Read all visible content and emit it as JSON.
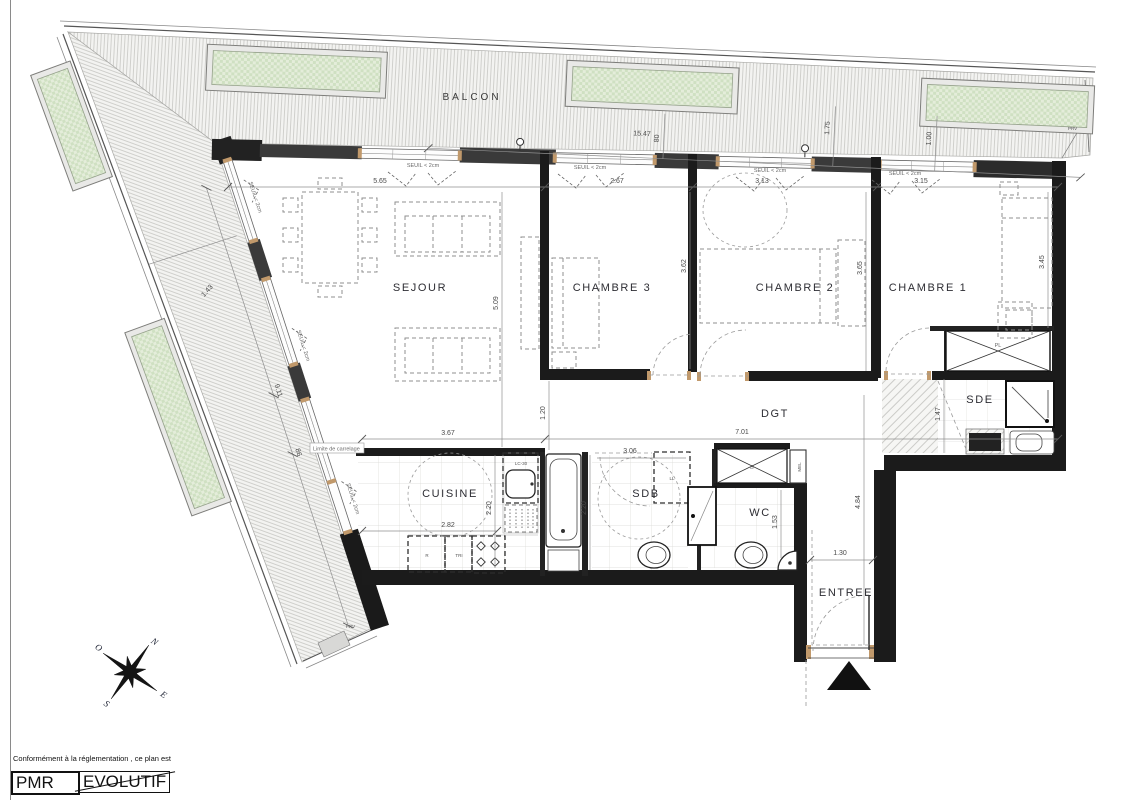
{
  "rooms": {
    "balcon": "BALCON",
    "sejour": "SEJOUR",
    "chambre3": "CHAMBRE 3",
    "chambre2": "CHAMBRE 2",
    "chambre1": "CHAMBRE 1",
    "dgt": "DGT",
    "cuisine": "CUISINE",
    "sdb": "SDB",
    "wc": "WC",
    "sde": "SDE",
    "entree": "ENTREE"
  },
  "dims": {
    "balcony_length": "15.47",
    "balcony_depth": "80",
    "balcony_d175": "1.75",
    "balcony_d100": "1.00",
    "sejour_w": "5.65",
    "ch3_w": "2.67",
    "ch2_w": "3.13",
    "ch1_w": "3.15",
    "sejour_h": "5.09",
    "ch3_h": "3.62",
    "ch2_h": "3.65",
    "ch1_h": "3.45",
    "terrace_w": "1.43",
    "terrace_l": "9.11",
    "terrace_l2": "86",
    "kitchen_w": "3.67",
    "kitchen_w2": "2.82",
    "kitchen_h": "2.20",
    "sdb_h": "2.20",
    "sdb_w": "3.06",
    "dgt_l": "7.01",
    "dgt_w": "1.20",
    "sde_w": "1.47",
    "wc_d": "1.53",
    "entree_h": "4.84",
    "entree_w": "1.30"
  },
  "annotations": {
    "seuil": "SEUIL < 2cm",
    "limite": "Limite de carrelage",
    "prv": "PRV",
    "lc30": "LC-30",
    "ll": "LL",
    "r": "R",
    "tri": "TRI",
    "b": "B",
    "mel": "MEL",
    "pl": "PL"
  },
  "compass": {
    "n": "N",
    "e": "E",
    "s": "S",
    "o": "O"
  },
  "footer": {
    "note": "Conformément à la réglementation , ce plan est",
    "pmr": "PMR",
    "evolutif": "EVOLUTIF"
  },
  "colors": {
    "wall": "#1b1b1b",
    "pier": "#3a3a3a",
    "planter_green": "#dbe7cf",
    "hatch_line": "#c7c7c3",
    "dim_text": "#4a4a4a"
  }
}
